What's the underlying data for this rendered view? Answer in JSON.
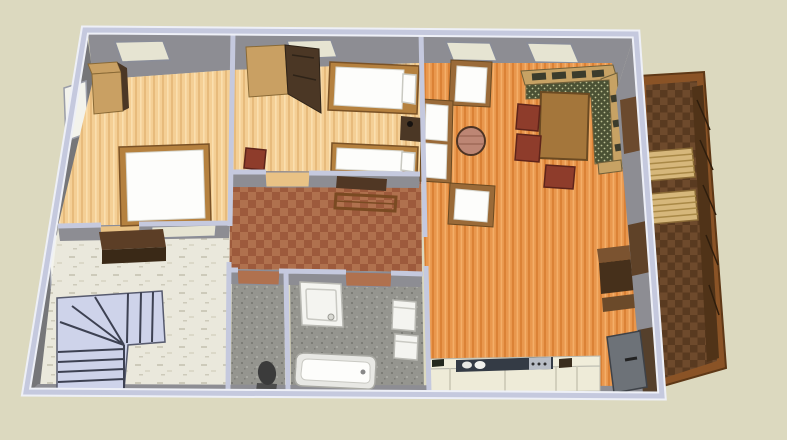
{
  "colors": {
    "background": "#dcd9bf",
    "wallTop": "#c5c9de",
    "wallHighlight": "#eef0f7",
    "wallGray": "#8d8d93",
    "wallGrayDark": "#767679",
    "skylight": "#e6e4d2",
    "windowWhite": "#f3f3ec",
    "woodLightBase": "#f4cf95",
    "woodLightGrain": "#e7bb7c",
    "woodLightGrain2": "#fadfae",
    "woodOrangeBase": "#e9974d",
    "woodOrangeGrain": "#db8236",
    "woodOrangeGrain2": "#f4ae68",
    "tileA": "#b0714e",
    "tileB": "#9d5a3c",
    "marbleBase": "#eae8dc",
    "marbleFleck1": "#cdcaba",
    "marbleFleck2": "#dbd8c8",
    "bathBase": "#95958f",
    "bathDark": "#7c7c76",
    "bathLight": "#a8a8a2",
    "balconyA": "#6e4a2c",
    "balconyB": "#593a20",
    "balconyFrame": "#8a5326",
    "balconyFence": "#503318",
    "benchWood": "#d6b77b",
    "stairFill": "#ced3ea",
    "stairLine": "#3d4152",
    "bedWood": "#b5813f",
    "mattressWhite": "#fdfdfb",
    "wardrobeTan": "#c9a063",
    "wardrobeDark": "#4b3725",
    "chairRed": "#8e3c2b",
    "chairWood": "#9a6a38",
    "sofaFrame": "#c7a264",
    "sofaSlat": "#3c3c2c",
    "sofaSeat": "#4b5134",
    "sofaDot": "#bcbf92",
    "tableBrown": "#a4763b",
    "tablePink": "#bd8674",
    "counterCream": "#f0edda",
    "counterFront": "#eeebd8",
    "counterDark": "#343b45",
    "stoveGray": "#b9bec6",
    "doorGray": "#6d7278",
    "toiletDark": "#3b3b3b",
    "fixtureWhite": "#f4f4f0",
    "shelfBrown": "#503724",
    "deskBrown": "#5c3e26",
    "deskFront": "#3a2917",
    "openingDark1": "#6b4a2e",
    "openingDark2": "#5f4228",
    "openingDark3": "#55402c",
    "doorwayWood": "#e9c285"
  },
  "objects": [
    "double-bed",
    "single-beds",
    "wardrobes",
    "nightstand",
    "corner-sofa",
    "dining-table",
    "dining-chairs",
    "armchairs",
    "round-table",
    "kitchen-counter",
    "sink-and-stove",
    "bathtub",
    "shower-tray",
    "washbasin",
    "washing-machine",
    "toilet",
    "winder-staircase",
    "hall-bench",
    "wall-shelf",
    "desk",
    "balcony",
    "balcony-benches",
    "skylight-windows",
    "wall-windows",
    "entry-door"
  ]
}
